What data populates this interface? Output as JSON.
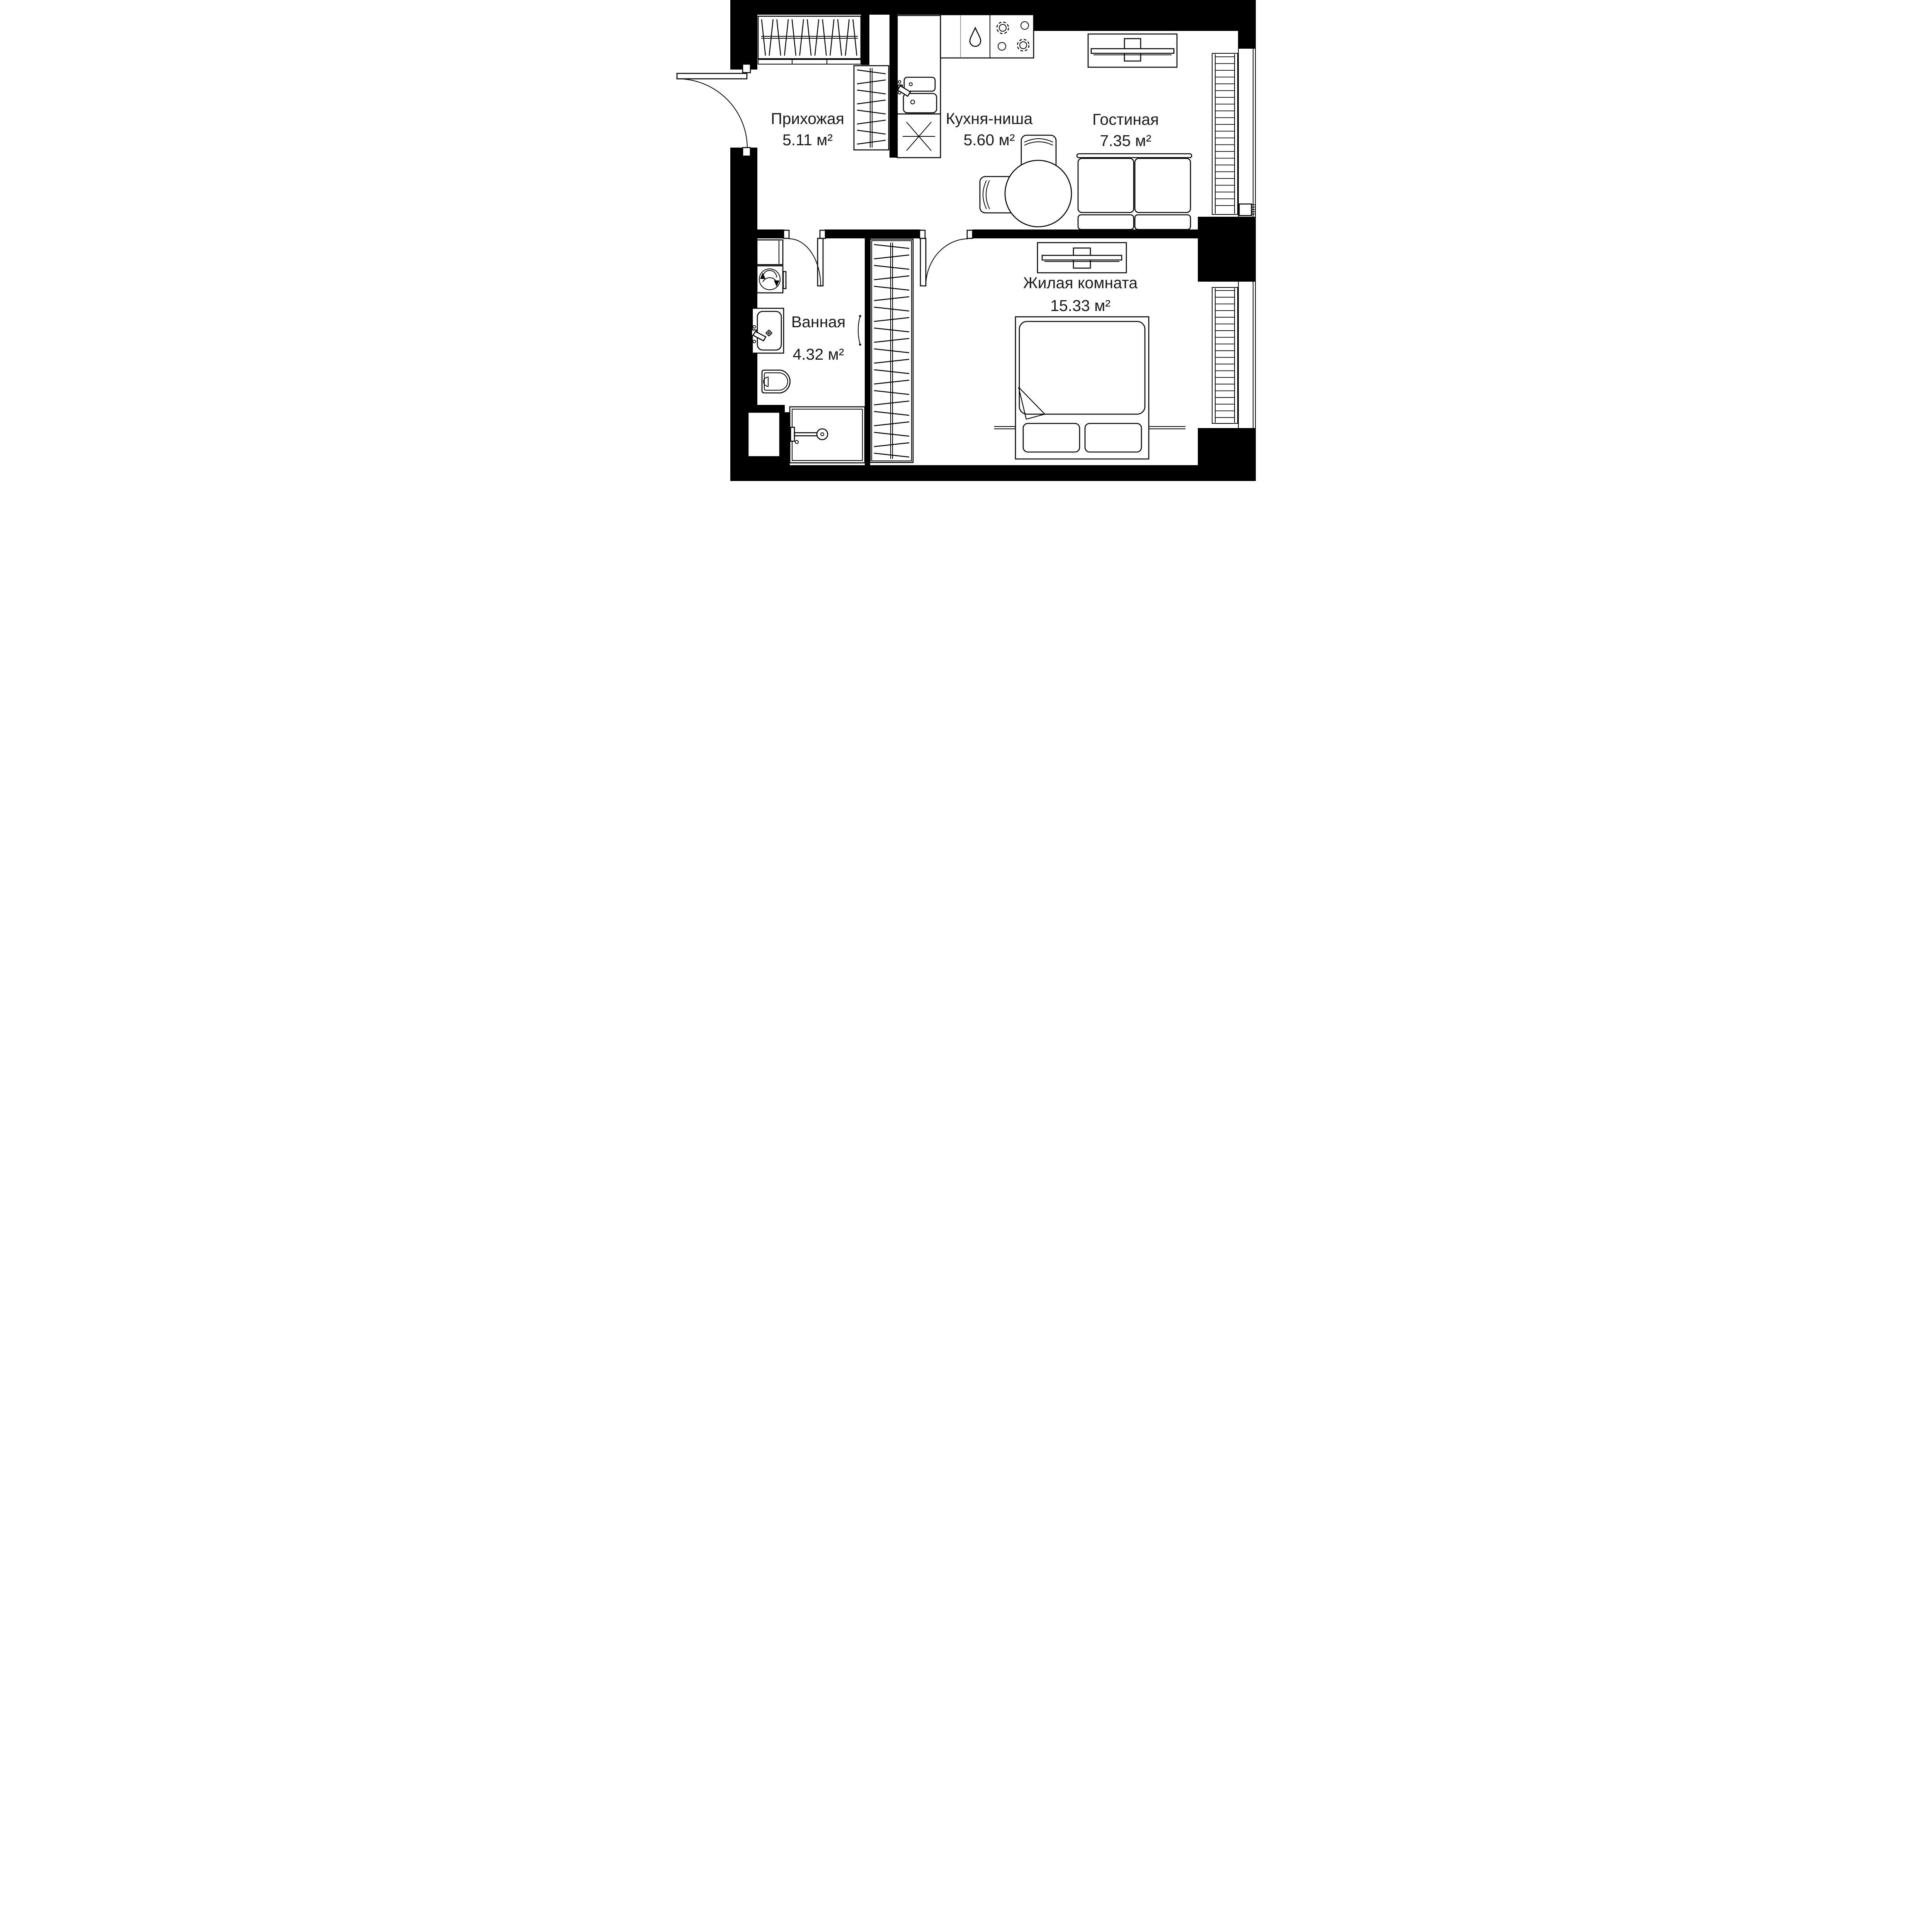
{
  "plan": {
    "rooms": [
      {
        "name": "Прихожая",
        "area": "5.11 м²"
      },
      {
        "name": "Кухня-ниша",
        "area": "5.60 м²"
      },
      {
        "name": "Гостиная",
        "area": "7.35 м²"
      },
      {
        "name": "Ванная",
        "area": "4.32 м²"
      },
      {
        "name": "Жилая комната",
        "area": "15.33 м²"
      }
    ],
    "fixtures": [
      "entrance-door",
      "coat-closet",
      "tall-closet",
      "wardrobe",
      "kitchen-sink",
      "dishwasher",
      "cooktop",
      "fridge-space",
      "tv-console-living",
      "tv-console-bedroom",
      "dining-table",
      "chairs",
      "sofa",
      "bed",
      "washing-machine",
      "bathroom-sink",
      "toilet",
      "shower",
      "radiator-window-top",
      "radiator-window-bottom"
    ],
    "colors": {
      "wall": "#000000",
      "line": "#000000",
      "text": "#1b1b1b",
      "background": "#ffffff",
      "divider": "#9a9a9a"
    }
  }
}
